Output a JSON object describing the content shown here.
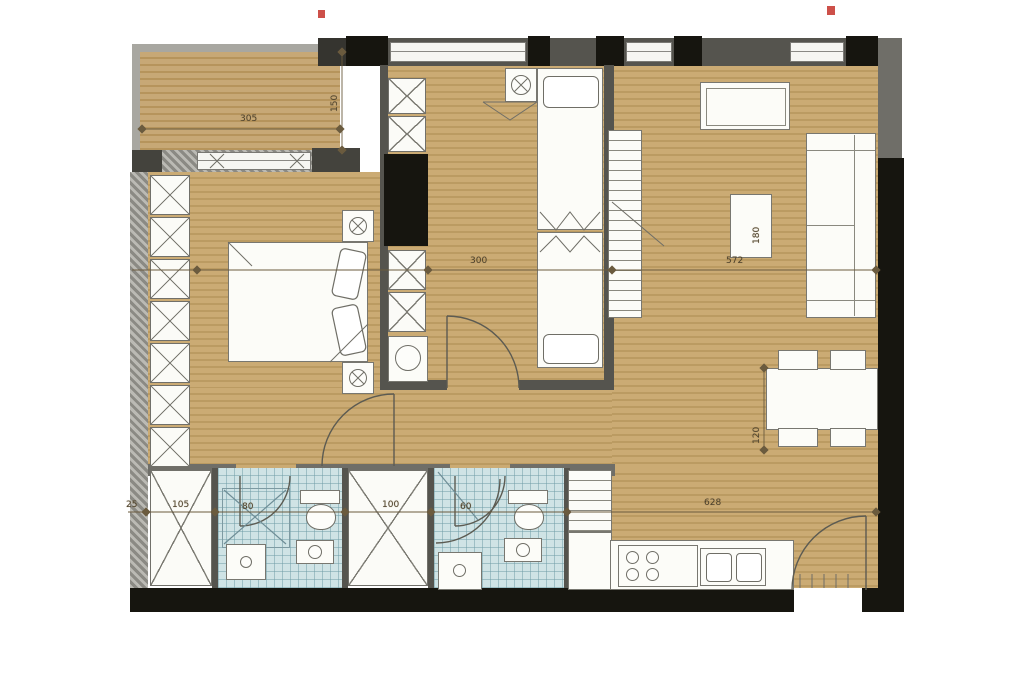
{
  "plan": {
    "type": "apartment-floor-plan"
  },
  "dimensions": {
    "balcony_width": "305",
    "balcony_depth": "150",
    "bedroom_width": "300",
    "living_width": "572",
    "media_unit_depth": "180",
    "dining_clearance": "120",
    "left_wall": "25",
    "closet_1": "105",
    "bathroom_1": "80",
    "closet_2": "100",
    "bathroom_2": "60",
    "kitchen_run": "628"
  },
  "colors": {
    "wood_floor": "#c9a96e",
    "wood_stripe": "#bb9b62",
    "bathroom_tile": "#cfe3e5",
    "wall_gray": "#55544e",
    "wall_black": "#16150f",
    "furniture": "#fcfcf8"
  }
}
